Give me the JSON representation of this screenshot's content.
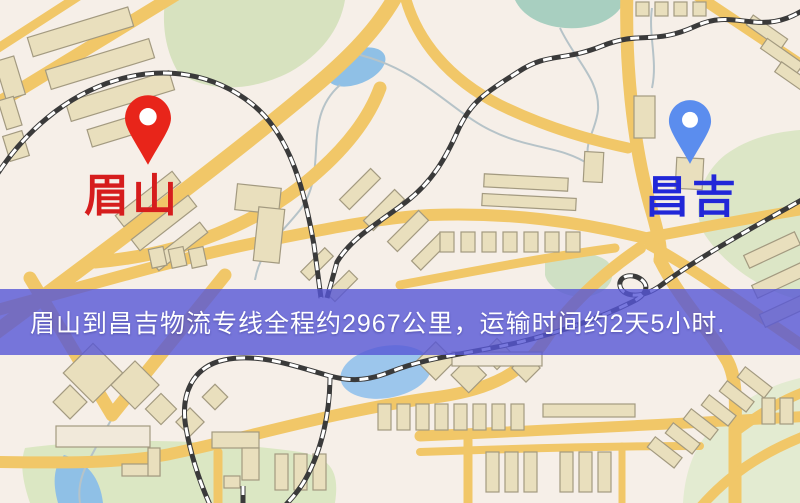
{
  "banner": {
    "text": "眉山到昌吉物流专线全程约2967公里，运输时间约2天5小时.",
    "bg": "rgba(86,86,214,0.8)",
    "text_color": "#ffffff"
  },
  "markers": {
    "origin": {
      "label": "眉山",
      "pin_icon": "red-location-pin-icon",
      "pin_color": "#e8251a",
      "label_color": "#d61d1d"
    },
    "destination": {
      "label": "昌吉",
      "pin_icon": "blue-location-pin-icon",
      "pin_color": "#5b8dee",
      "label_color": "#2127d8"
    }
  },
  "map": {
    "kind": "street-map",
    "palette": {
      "background": "#f6efe8",
      "road": "#f1c768",
      "park": "#d7e2bf",
      "water": "#8fc0e6",
      "building": "#e9dfbd",
      "railway": "#3a3a3a"
    }
  }
}
